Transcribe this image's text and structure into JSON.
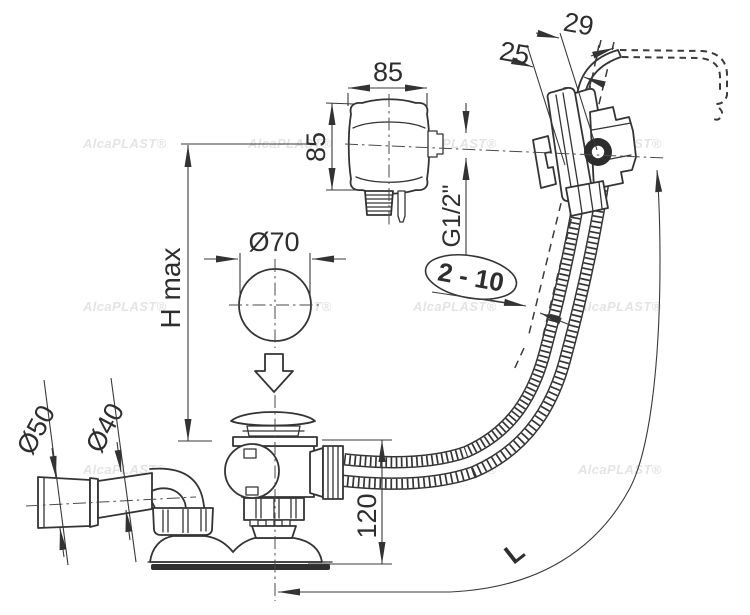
{
  "drawing": {
    "watermark": {
      "text": "AlcaPLAST®"
    },
    "labels": {
      "knob_width": "85",
      "knob_height": "85",
      "rim_offset_inner": "25",
      "rim_offset_outer": "29",
      "thread_size": "G1/2\"",
      "wall_thickness_range": "2 - 10",
      "plug_diameter": "Ø70",
      "max_height": "H max",
      "socket_diameter": "Ø50",
      "pipe_diameter": "Ø40",
      "waste_body_height": "120",
      "hose_length": "L"
    }
  }
}
